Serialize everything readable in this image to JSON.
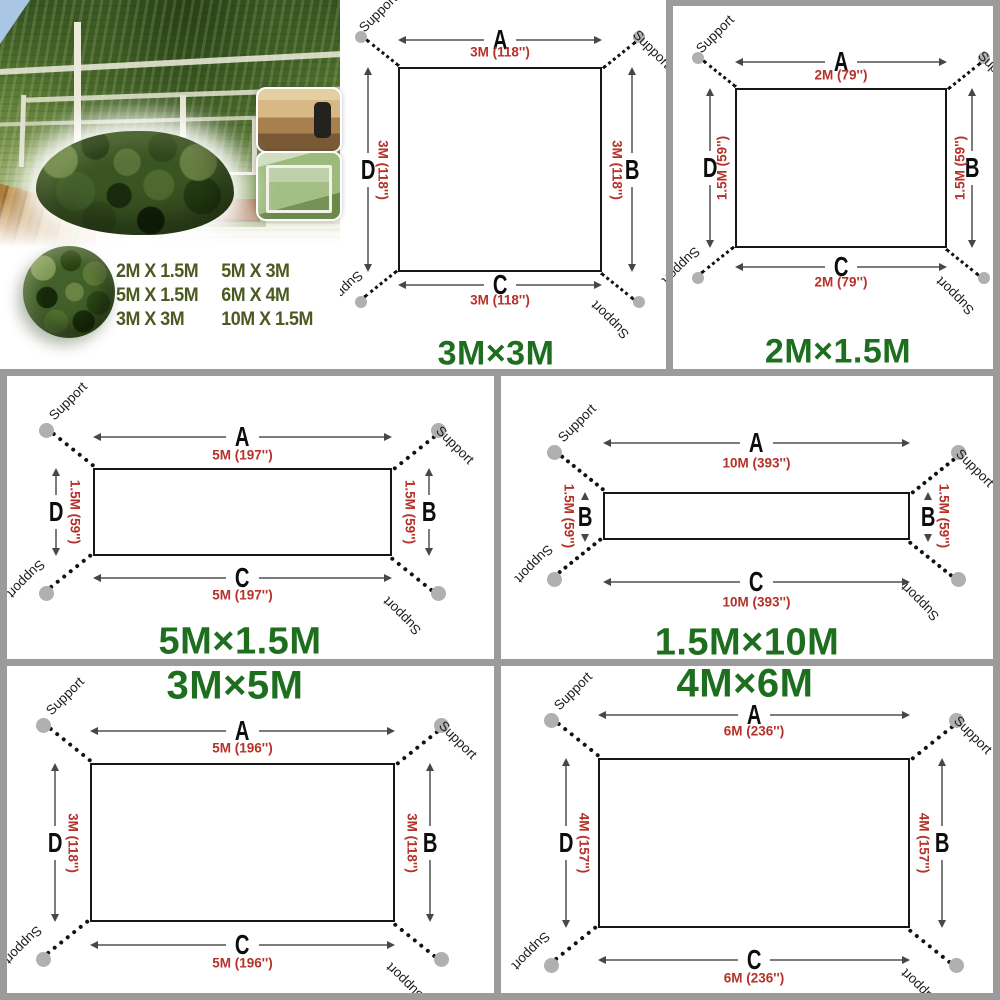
{
  "labels": {
    "support": "Support"
  },
  "photo": {
    "sizes_col1": [
      "2M X 1.5M",
      "5M X 1.5M",
      "3M X 3M"
    ],
    "sizes_col2": [
      "5M X 3M",
      "6M X 4M",
      "10M X 1.5M"
    ]
  },
  "diagrams": [
    {
      "id": "d3x3",
      "title": "3M×3M",
      "top_letter": "A",
      "bottom_letter": "C",
      "left_letter": "D",
      "right_letter": "B",
      "width_dim": "3M (118'')",
      "height_dim": "3M (118'')",
      "flip_side_text": false
    },
    {
      "id": "d2x15",
      "title": "2M×1.5M",
      "top_letter": "A",
      "bottom_letter": "C",
      "left_letter": "D",
      "right_letter": "B",
      "width_dim": "2M (79'')",
      "height_dim": "1.5M (59'')",
      "flip_side_text": true
    },
    {
      "id": "d5x15",
      "title": "5M×1.5M",
      "top_letter": "A",
      "bottom_letter": "C",
      "left_letter": "D",
      "right_letter": "B",
      "width_dim": "5M (197'')",
      "height_dim": "1.5M (59'')",
      "flip_side_text": false
    },
    {
      "id": "d15x10",
      "title": "1.5M×10M",
      "top_letter": "A",
      "bottom_letter": "C",
      "left_letter": "B",
      "right_letter": "B",
      "width_dim": "10M (393'')",
      "height_dim": "1.5M (59'')",
      "flip_side_text": false
    },
    {
      "id": "d3x5",
      "title": "3M×5M",
      "top_letter": "A",
      "bottom_letter": "C",
      "left_letter": "D",
      "right_letter": "B",
      "width_dim": "5M (196'')",
      "height_dim": "3M (118'')",
      "flip_side_text": false
    },
    {
      "id": "d4x6",
      "title": "4M×6M",
      "top_letter": "A",
      "bottom_letter": "C",
      "left_letter": "D",
      "right_letter": "B",
      "width_dim": "6M (236'')",
      "height_dim": "4M (157'')",
      "flip_side_text": false
    }
  ],
  "colors": {
    "title_green": "#1e6e20",
    "dim_red": "#b53129",
    "support_dot": "#b0b0b0",
    "size_text_olive": "#4c5a21",
    "grid_gray": "#9b9b9b"
  }
}
